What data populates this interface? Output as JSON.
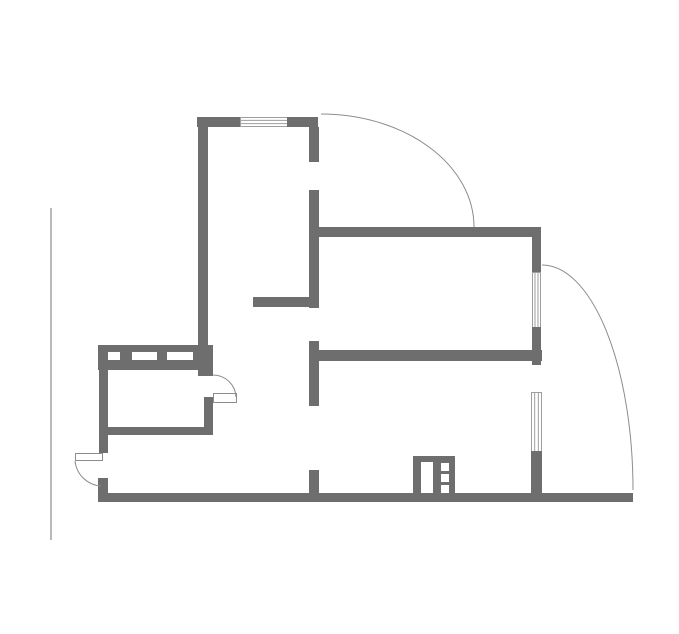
{
  "plan": {
    "canvas": {
      "width": 679,
      "height": 634,
      "background": "#ffffff"
    },
    "palette": {
      "wall": "#6e6e6e",
      "line": "#8c8c8c",
      "window_border": "#9e9e9e",
      "white": "#ffffff"
    },
    "elements": [
      {
        "name": "room1-top-wall-left",
        "type": "rect",
        "fill": "wall",
        "x": 197,
        "y": 117,
        "w": 44,
        "h": 10
      },
      {
        "name": "room1-top-window",
        "type": "window",
        "orient": "h",
        "x": 240,
        "y": 117,
        "w": 48,
        "h": 10
      },
      {
        "name": "room1-top-wall-right",
        "type": "rect",
        "fill": "wall",
        "x": 287,
        "y": 117,
        "w": 31,
        "h": 10
      },
      {
        "name": "room1-left-wall",
        "type": "rect",
        "fill": "wall",
        "x": 198,
        "y": 117,
        "w": 10,
        "h": 230
      },
      {
        "name": "partition-wall-upper-a",
        "type": "rect",
        "fill": "wall",
        "x": 309,
        "y": 127,
        "w": 10,
        "h": 35
      },
      {
        "name": "partition-wall-upper-b",
        "type": "rect",
        "fill": "wall",
        "x": 309,
        "y": 190,
        "w": 10,
        "h": 118
      },
      {
        "name": "hall-stub-wall",
        "type": "rect",
        "fill": "wall",
        "x": 253,
        "y": 297,
        "w": 66,
        "h": 10
      },
      {
        "name": "partition-wall-mid",
        "type": "rect",
        "fill": "wall",
        "x": 309,
        "y": 341,
        "w": 10,
        "h": 65
      },
      {
        "name": "partition-wall-lower",
        "type": "rect",
        "fill": "wall",
        "x": 309,
        "y": 470,
        "w": 10,
        "h": 30
      },
      {
        "name": "room2-top-wall",
        "type": "rect",
        "fill": "wall",
        "x": 314,
        "y": 227,
        "w": 227,
        "h": 10
      },
      {
        "name": "room2-right-wall-upper",
        "type": "rect",
        "fill": "wall",
        "x": 532,
        "y": 227,
        "w": 9,
        "h": 46
      },
      {
        "name": "room2-right-window",
        "type": "window",
        "orient": "v",
        "x": 532,
        "y": 272,
        "w": 9,
        "h": 56
      },
      {
        "name": "room2-right-wall-lower",
        "type": "rect",
        "fill": "wall",
        "x": 532,
        "y": 327,
        "w": 9,
        "h": 38
      },
      {
        "name": "room2-bottom-wall",
        "type": "rect",
        "fill": "wall",
        "x": 319,
        "y": 350,
        "w": 223,
        "h": 11
      },
      {
        "name": "hall-right-window",
        "type": "window",
        "orient": "v",
        "x": 531,
        "y": 392,
        "w": 11,
        "h": 60
      },
      {
        "name": "right-wall-below-window",
        "type": "rect",
        "fill": "wall",
        "x": 531,
        "y": 451,
        "w": 11,
        "h": 46
      },
      {
        "name": "bottom-exterior-wall",
        "type": "rect",
        "fill": "wall",
        "x": 98,
        "y": 493,
        "w": 535,
        "h": 9
      },
      {
        "name": "bottom-left-corner-wall",
        "type": "rect",
        "fill": "wall",
        "x": 98,
        "y": 478,
        "w": 10,
        "h": 17
      },
      {
        "name": "left-exterior-wall",
        "type": "rect",
        "fill": "wall",
        "x": 99,
        "y": 368,
        "w": 9,
        "h": 85
      },
      {
        "name": "closet-band-wall",
        "type": "rect",
        "fill": "wall",
        "x": 98,
        "y": 345,
        "w": 115,
        "h": 25
      },
      {
        "name": "closet-band-slot-1",
        "type": "rect",
        "fill": "white",
        "x": 108,
        "y": 352,
        "w": 12,
        "h": 8
      },
      {
        "name": "closet-band-slot-2",
        "type": "rect",
        "fill": "white",
        "x": 132,
        "y": 352,
        "w": 25,
        "h": 8
      },
      {
        "name": "closet-band-slot-3",
        "type": "rect",
        "fill": "white",
        "x": 167,
        "y": 352,
        "w": 26,
        "h": 8
      },
      {
        "name": "closet-right-wall-top",
        "type": "rect",
        "fill": "wall",
        "x": 198,
        "y": 368,
        "w": 15,
        "h": 8
      },
      {
        "name": "closet-right-wall-bottom",
        "type": "rect",
        "fill": "wall",
        "x": 204,
        "y": 397,
        "w": 9,
        "h": 38
      },
      {
        "name": "closet-bottom-wall",
        "type": "rect",
        "fill": "wall",
        "x": 103,
        "y": 427,
        "w": 110,
        "h": 8
      },
      {
        "name": "vent-shaft-block",
        "type": "rect",
        "fill": "wall",
        "x": 413,
        "y": 456,
        "w": 42,
        "h": 41
      },
      {
        "name": "vent-shaft-panel",
        "type": "rect",
        "fill": "white",
        "x": 421,
        "y": 462,
        "w": 12,
        "h": 31
      },
      {
        "name": "vent-shaft-cell-1",
        "type": "rect",
        "fill": "white",
        "x": 441,
        "y": 463,
        "w": 8,
        "h": 8
      },
      {
        "name": "vent-shaft-cell-2",
        "type": "rect",
        "fill": "white",
        "x": 441,
        "y": 474,
        "w": 8,
        "h": 8
      },
      {
        "name": "vent-shaft-cell-3",
        "type": "rect",
        "fill": "white",
        "x": 441,
        "y": 485,
        "w": 8,
        "h": 8
      },
      {
        "name": "entrance-door-leaf",
        "type": "leaf",
        "x": 75,
        "y": 453,
        "w": 28,
        "h": 8
      },
      {
        "name": "closet-door-leaf",
        "type": "leaf",
        "x": 213,
        "y": 393,
        "w": 24,
        "h": 10
      },
      {
        "name": "room1-door-swing-arc",
        "type": "arc",
        "d": "M 321 114 A 153 113 0 0 1 474 227"
      },
      {
        "name": "balcony-door-swing-arc",
        "type": "arc",
        "d": "M 542 265 A 91 225 0 0 1 633 490"
      },
      {
        "name": "closet-door-swing-arc",
        "type": "arc",
        "d": "M 213 375 A 23 23 0 0 1 236 397"
      },
      {
        "name": "entrance-door-swing-arc",
        "type": "arc",
        "d": "M 75 461 A 28 28 0 0 0 101 486"
      },
      {
        "name": "left-reference-line",
        "type": "line",
        "x1": 51,
        "y1": 208,
        "x2": 51,
        "y2": 540
      }
    ]
  }
}
